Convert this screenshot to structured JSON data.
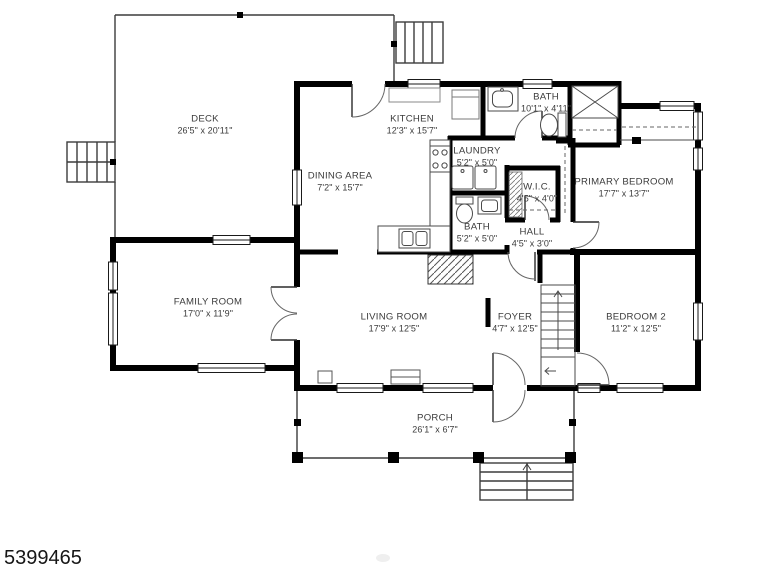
{
  "plan": {
    "type": "residential-floor-plan",
    "rooms": [
      {
        "id": "deck",
        "name": "DECK",
        "dims": "26'5\" x 20'11\""
      },
      {
        "id": "kitchen",
        "name": "KITCHEN",
        "dims": "12'3\" x 15'7\""
      },
      {
        "id": "bath-upper",
        "name": "BATH",
        "dims": "10'1\" x 4'11\""
      },
      {
        "id": "laundry",
        "name": "LAUNDRY",
        "dims": "5'2\" x 5'0\""
      },
      {
        "id": "wic",
        "name": "W.I.C.",
        "dims": "4'5\" x 4'0\""
      },
      {
        "id": "primary-bedroom",
        "name": "PRIMARY BEDROOM",
        "dims": "17'7\" x 13'7\""
      },
      {
        "id": "dining-area",
        "name": "DINING AREA",
        "dims": "7'2\" x 15'7\""
      },
      {
        "id": "bath-lower",
        "name": "BATH",
        "dims": "5'2\" x 5'0\""
      },
      {
        "id": "hall",
        "name": "HALL",
        "dims": "4'5\" x 3'0\""
      },
      {
        "id": "family-room",
        "name": "FAMILY ROOM",
        "dims": "17'0\" x 11'9\""
      },
      {
        "id": "living-room",
        "name": "LIVING ROOM",
        "dims": "17'9\" x 12'5\""
      },
      {
        "id": "foyer",
        "name": "FOYER",
        "dims": "4'7\" x 12'5\""
      },
      {
        "id": "bedroom-2",
        "name": "BEDROOM 2",
        "dims": "11'2\" x 12'5\""
      },
      {
        "id": "porch",
        "name": "PORCH",
        "dims": "26'1\" x 6'7\""
      }
    ],
    "fixtures": [
      "toilet",
      "sink",
      "vanity",
      "shower",
      "washer-dryer",
      "range",
      "refrigerator",
      "kitchen-counter",
      "closet-rod",
      "staircase",
      "basement-stair-hatch",
      "deck-stairs",
      "porch-steps"
    ],
    "colors": {
      "wall": "#000000",
      "thin_line": "#3c3c3c",
      "label_text": "#3b3b3b",
      "background": "#ffffff"
    }
  },
  "footer": {
    "listing_id": "5399465"
  }
}
